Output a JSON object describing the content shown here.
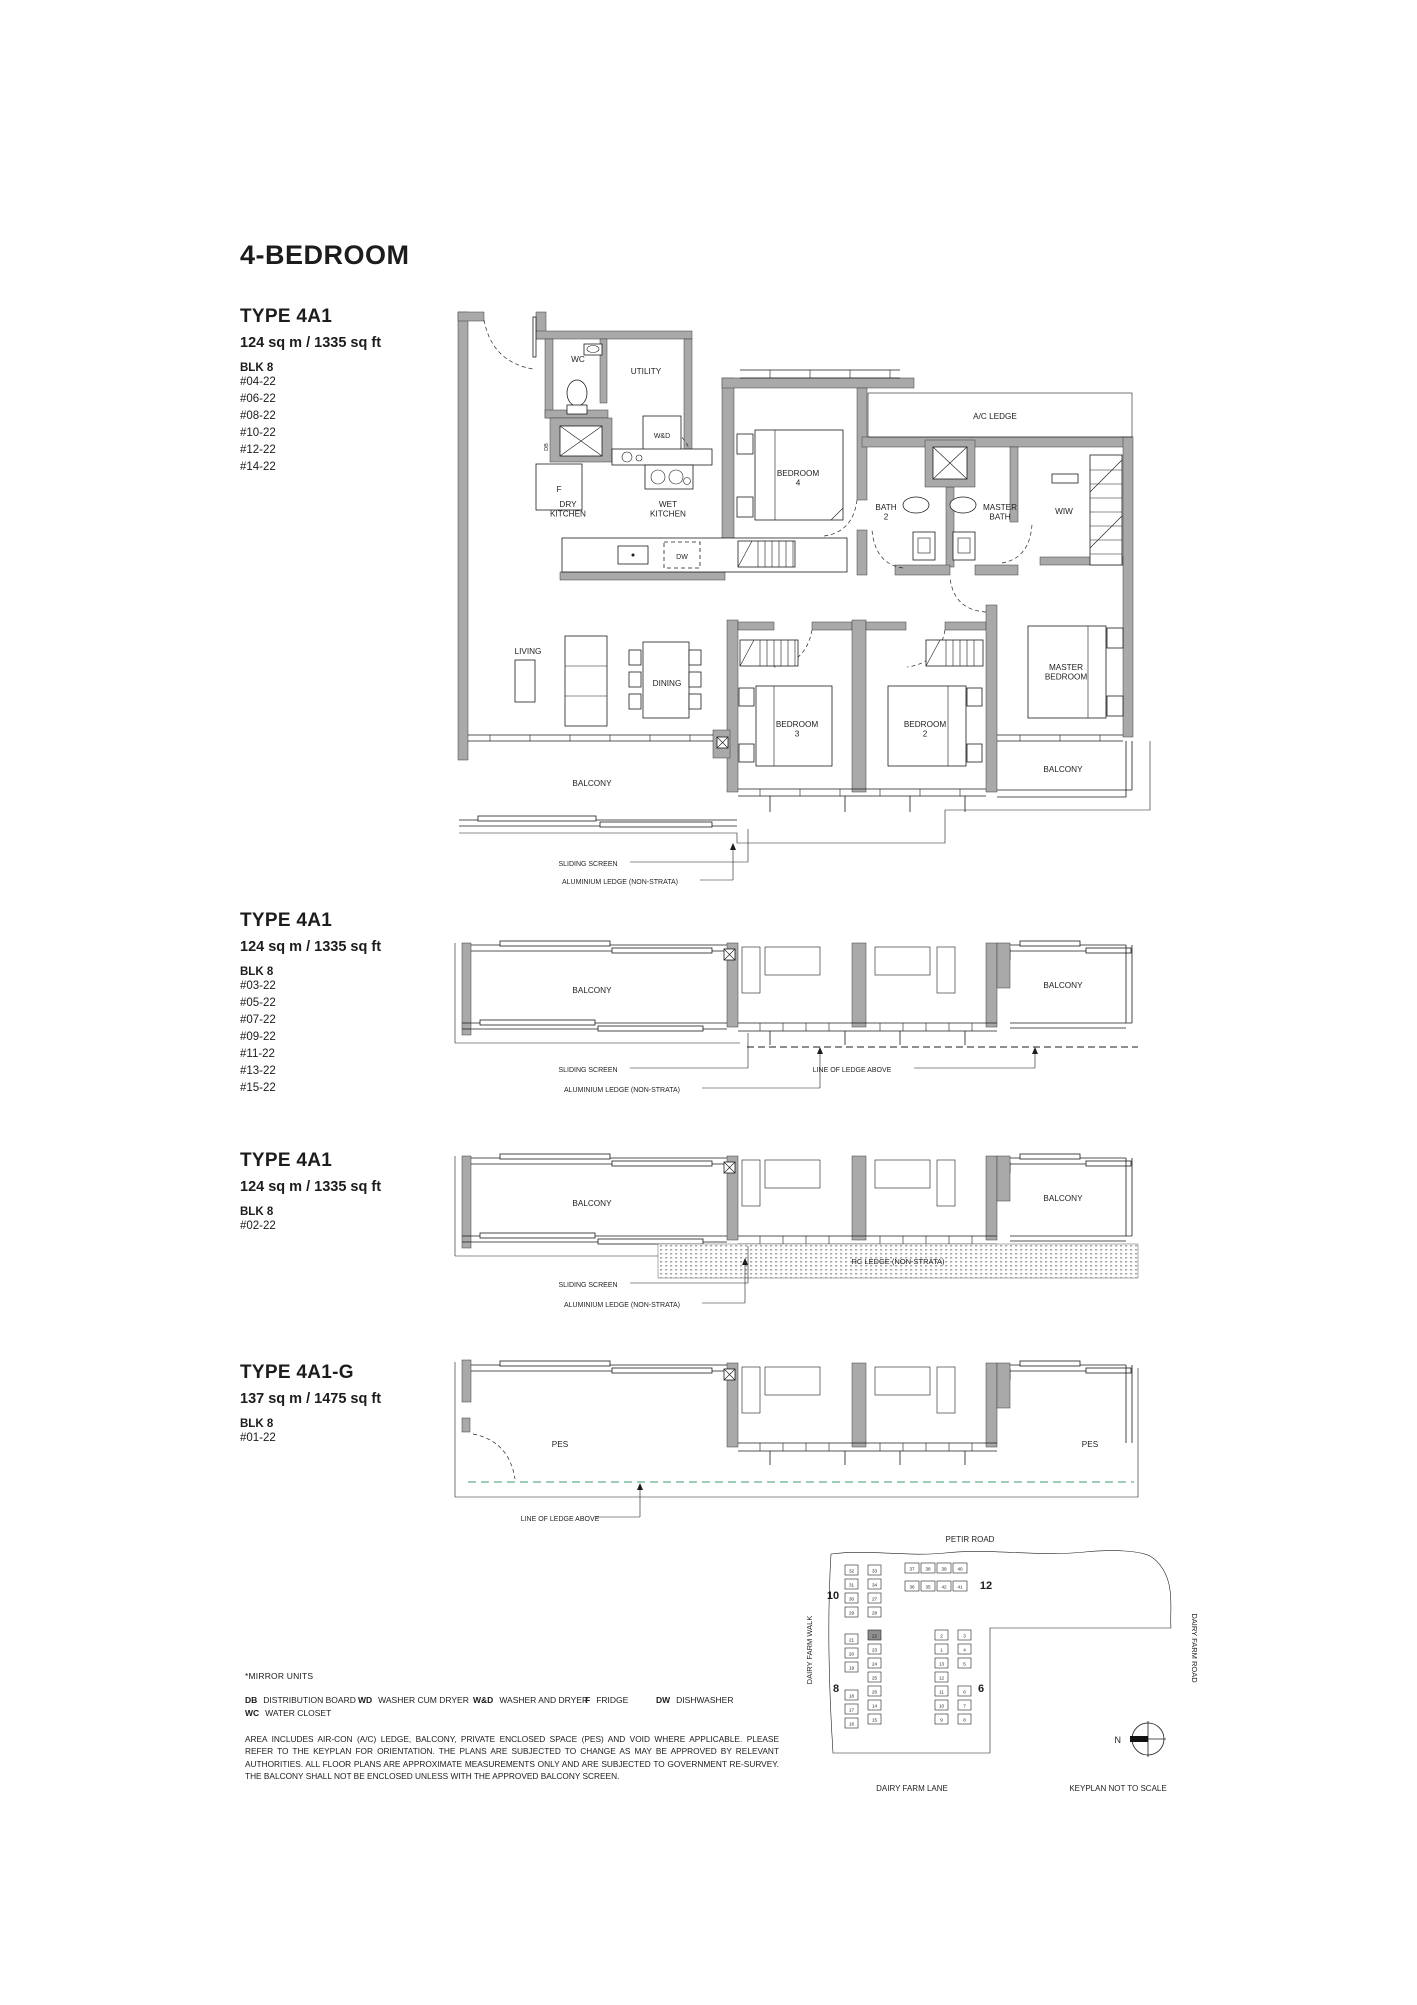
{
  "title": "4-BEDROOM",
  "sections": [
    {
      "type": "TYPE 4A1",
      "area": "124 sq m / 1335 sq ft",
      "blk": "BLK 8",
      "units": [
        "#04-22",
        "#06-22",
        "#08-22",
        "#10-22",
        "#12-22",
        "#14-22"
      ]
    },
    {
      "type": "TYPE 4A1",
      "area": "124 sq m / 1335 sq ft",
      "blk": "BLK 8",
      "units": [
        "#03-22",
        "#05-22",
        "#07-22",
        "#09-22",
        "#11-22",
        "#13-22",
        "#15-22"
      ]
    },
    {
      "type": "TYPE 4A1",
      "area": "124 sq m / 1335 sq ft",
      "blk": "BLK 8",
      "units": [
        "#02-22"
      ]
    },
    {
      "type": "TYPE 4A1-G",
      "area": "137 sq m / 1475 sq ft",
      "blk": "BLK 8",
      "units": [
        "#01-22"
      ]
    }
  ],
  "plan": {
    "wc": "WC",
    "utility": "UTILITY",
    "wd": "W&D",
    "db": "DB",
    "fridge": "F",
    "dry_kitchen": "DRY\nKITCHEN",
    "wet_kitchen": "WET\nKITCHEN",
    "dw": "DW",
    "bedroom4": "BEDROOM\n4",
    "ac_ledge": "A/C LEDGE",
    "bath2": "BATH\n2",
    "master_bath": "MASTER\nBATH",
    "wiw": "WIW",
    "living": "LIVING",
    "dining": "DINING",
    "bedroom3": "BEDROOM\n3",
    "bedroom2": "BEDROOM\n2",
    "master_bedroom": "MASTER\nBEDROOM",
    "balcony": "BALCONY",
    "pes": "PES",
    "sliding_screen": "SLIDING SCREEN",
    "aluminium_ledge": "ALUMINIUM LEDGE (NON-STRATA)",
    "line_of_ledge": "LINE OF LEDGE ABOVE",
    "rc_ledge": "RC LEDGE (NON-STRATA)"
  },
  "legend": {
    "mirror": "*MIRROR UNITS",
    "items": [
      {
        "abbr": "DB",
        "label": "DISTRIBUTION BOARD"
      },
      {
        "abbr": "WD",
        "label": "WASHER CUM DRYER"
      },
      {
        "abbr": "W&D",
        "label": "WASHER AND DRYER"
      },
      {
        "abbr": "F",
        "label": "FRIDGE"
      },
      {
        "abbr": "DW",
        "label": "DISHWASHER"
      },
      {
        "abbr": "WC",
        "label": "WATER CLOSET"
      }
    ],
    "disclaimer": "AREA INCLUDES AIR-CON (A/C) LEDGE, BALCONY, PRIVATE ENCLOSED SPACE (PES) AND VOID WHERE APPLICABLE. PLEASE REFER TO THE KEYPLAN FOR ORIENTATION. THE PLANS ARE SUBJECTED TO CHANGE AS MAY BE APPROVED BY RELEVANT AUTHORITIES. ALL FLOOR PLANS ARE APPROXIMATE MEASUREMENTS ONLY AND ARE SUBJECTED TO GOVERNMENT RE-SURVEY. THE BALCONY SHALL NOT BE ENCLOSED UNLESS WITH THE APPROVED BALCONY SCREEN."
  },
  "keyplan": {
    "roads": {
      "top": "PETIR ROAD",
      "left": "DAIRY FARM WALK",
      "right": "DAIRY FARM ROAD",
      "bottom": "DAIRY FARM LANE"
    },
    "note": "KEYPLAN NOT TO SCALE",
    "north": "N",
    "highlight": {
      "block": "8",
      "unit": "22"
    },
    "blocks": [
      {
        "label": "10",
        "lx": 833,
        "ly": 1599,
        "strips": [
          {
            "x": 845,
            "y": 1565,
            "dx": 0,
            "dy": 14,
            "units": [
              "32",
              "31",
              "30",
              "29"
            ]
          },
          {
            "x": 868,
            "y": 1565,
            "dx": 0,
            "dy": 14,
            "units": [
              "33",
              "34",
              "27",
              "28"
            ]
          }
        ]
      },
      {
        "label": "12",
        "lx": 986,
        "ly": 1589,
        "strips": [
          {
            "x": 905,
            "y": 1563,
            "dx": 16,
            "dy": 0,
            "units": [
              "37",
              "38",
              "39",
              "40"
            ]
          },
          {
            "x": 905,
            "y": 1581,
            "dx": 16,
            "dy": 0,
            "units": [
              "36",
              "35",
              "42",
              "41"
            ]
          }
        ]
      },
      {
        "label": "8",
        "lx": 836,
        "ly": 1692,
        "strips": [
          {
            "x": 845,
            "y": 1634,
            "dx": 0,
            "dy": 14,
            "units": [
              "21",
              "20",
              "19",
              "",
              "18",
              "17",
              "16"
            ]
          },
          {
            "x": 868,
            "y": 1630,
            "dx": 0,
            "dy": 14,
            "units": [
              "22",
              "23",
              "24",
              "25",
              "26",
              "14",
              "15"
            ]
          }
        ]
      },
      {
        "label": "6",
        "lx": 981,
        "ly": 1692,
        "strips": [
          {
            "x": 935,
            "y": 1630,
            "dx": 0,
            "dy": 14,
            "units": [
              "2",
              "1",
              "13",
              "12",
              "11",
              "10",
              "9"
            ]
          },
          {
            "x": 958,
            "y": 1630,
            "dx": 0,
            "dy": 14,
            "units": [
              "3",
              "4",
              "5",
              "",
              "6",
              "7",
              "8"
            ]
          }
        ]
      }
    ]
  },
  "colors": {
    "wall": "#a9a9a9",
    "line": "#1c1c1c",
    "green_dash": "#3f9e6e",
    "highlight": "#8f8f8f"
  }
}
